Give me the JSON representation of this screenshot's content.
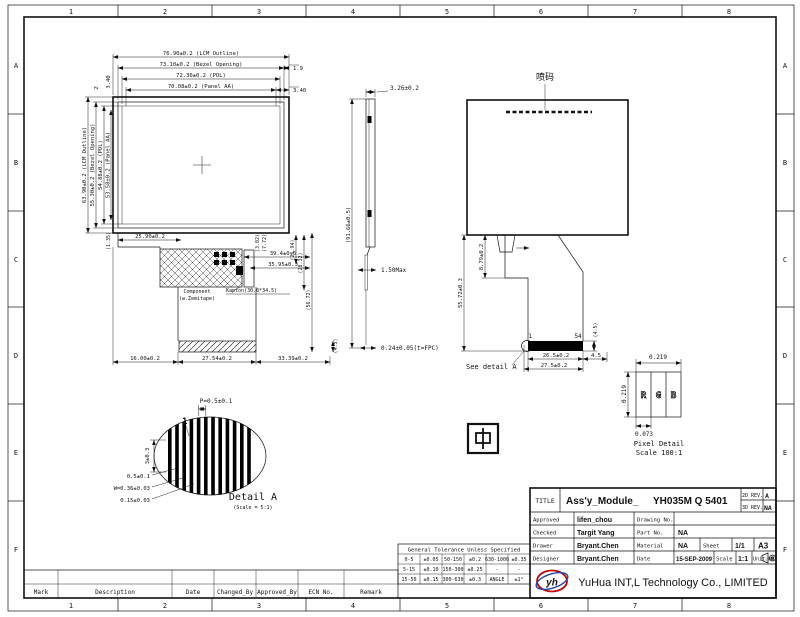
{
  "sheet": {
    "grid_cols": [
      "1",
      "2",
      "3",
      "4",
      "5",
      "6",
      "7",
      "8"
    ],
    "grid_rows": [
      "A",
      "B",
      "C",
      "D",
      "E",
      "F"
    ]
  },
  "front_view": {
    "dim_top_1": "76.90±0.2 (LCM Outline)",
    "dim_top_2": "73.10±0.2 (Bezel Opening)",
    "dim_top_3": "72.30±0.2 (POL)",
    "dim_top_4": "70.08±0.2 (Panel AA)",
    "dim_top_r1": "1.9",
    "dim_top_r2": "3.40",
    "dim_left_1": "63.90±0.2 (LCM Outline)",
    "dim_left_2": "55.30±0.2 (Bezel Opening)",
    "dim_left_3": "54.88±0.2 (POL)",
    "dim_left_4": "53.58±0.2 (Panel AA)",
    "dim_left_t1": "2",
    "dim_left_t2": "3.40",
    "dim_step": "25.90±0.2",
    "dim_step_v": "(1.35)",
    "dim_cog_w1": "39.4±0.5",
    "dim_cog_w2": "35.95±0.3",
    "dim_cog_v1": "(3.02)",
    "dim_cog_v2": "(7.72)",
    "label_component_1": "Component",
    "label_component_2": "(w.Zemitape)",
    "label_kapton": "Kapton(30.0*34.5)",
    "dim_bot_1": "16.00±0.2",
    "dim_bot_2": "27.54±0.2",
    "dim_bot_3": "33.39±0.2",
    "dim_right_1": "(26.94)",
    "dim_right_2": "(28.32)",
    "dim_right_3": "(56.72)",
    "dim_right_4": "(4.5)"
  },
  "side_view": {
    "dim_thickness": "3.26±0.2",
    "dim_total": "(91.66±0.5)",
    "dim_fpc": "1.50Max",
    "dim_tape": "0.24±0.05(t=FPC)"
  },
  "back_view": {
    "label_marking": "喷码",
    "pin_first": "1",
    "pin_last": "54",
    "dim_contacts": "26.5±0.2",
    "dim_fpc_width": "27.5±0.2",
    "dim_side": "4.5",
    "dim_bar_v": "(4.5)",
    "dim_tail_len": "55.72±0.3",
    "dim_tail_top": "8.79±0.2",
    "see_detail": "See detail A"
  },
  "detail_a": {
    "dim_pitch": "P=0.5±0.1",
    "pin_first": "1",
    "dim_height": "3±0.3",
    "dim_1": "0.5±0.1",
    "dim_2": "W=0.36±0.03",
    "dim_3": "0.15±0.03",
    "title": "Detail A",
    "scale": "(Scale = 5:1)"
  },
  "center_mark": {
    "glyph": "中"
  },
  "pixel_detail": {
    "dim_width": "0.219",
    "dim_height": "0.219",
    "dim_subpixel": "0.073",
    "r": "R",
    "g": "G",
    "b": "B",
    "title": "Pixel Detail",
    "scale": "Scale 100:1"
  },
  "title_block": {
    "title_label": "TITLE",
    "title_value_1": "Ass'y_Module_",
    "title_value_2": "YH035M Q 5401",
    "rev2d_label": "2D REV.",
    "rev2d_value": "A",
    "rev3d_label": "3D REV.",
    "rev3d_value": "NA",
    "approved_label": "Approved",
    "approved_value": "lifen_chou",
    "drawing_no_label": "Drawing No.",
    "drawing_no_value": "",
    "checked_label": "Checked",
    "checked_value": "Targit Yang",
    "part_no_label": "Part No.",
    "part_no_value": "NA",
    "drawer_label": "Drawer",
    "drawer_value": "Bryant.Chen",
    "material_label": "Material",
    "material_value": "NA",
    "sheet_label": "Sheet",
    "sheet_value": "1/1",
    "paper_size": "A3",
    "designer_label": "Designer",
    "designer_value": "Bryant.Chen",
    "date_label": "Date",
    "date_value": "15-SEP-2009",
    "scale_label": "Scale",
    "scale_value": "1:1",
    "unit_label": "Unit:mm",
    "company": "YuHua INT,L Technology Co., LIMITED",
    "logo_text": "yh",
    "logo_color": "#c00000",
    "logo_swirl_color": "#2244aa"
  },
  "tolerance_table": {
    "title": "General Tolerance Unless Specified",
    "rows": [
      [
        "0-5",
        "±0.05",
        "50-150",
        "±0.2",
        "630-1000",
        "±0.35"
      ],
      [
        "5-15",
        "±0.10",
        "150-300",
        "±0.25",
        "-",
        "-"
      ],
      [
        "15-50",
        "±0.15",
        "300-630",
        "±0.3",
        "ANGLE",
        "±1°"
      ]
    ]
  },
  "revision_table": {
    "headers": [
      "Mark",
      "Description",
      "Date",
      "Changed_By",
      "Approved_By",
      "ECN No.",
      "Remark"
    ]
  }
}
